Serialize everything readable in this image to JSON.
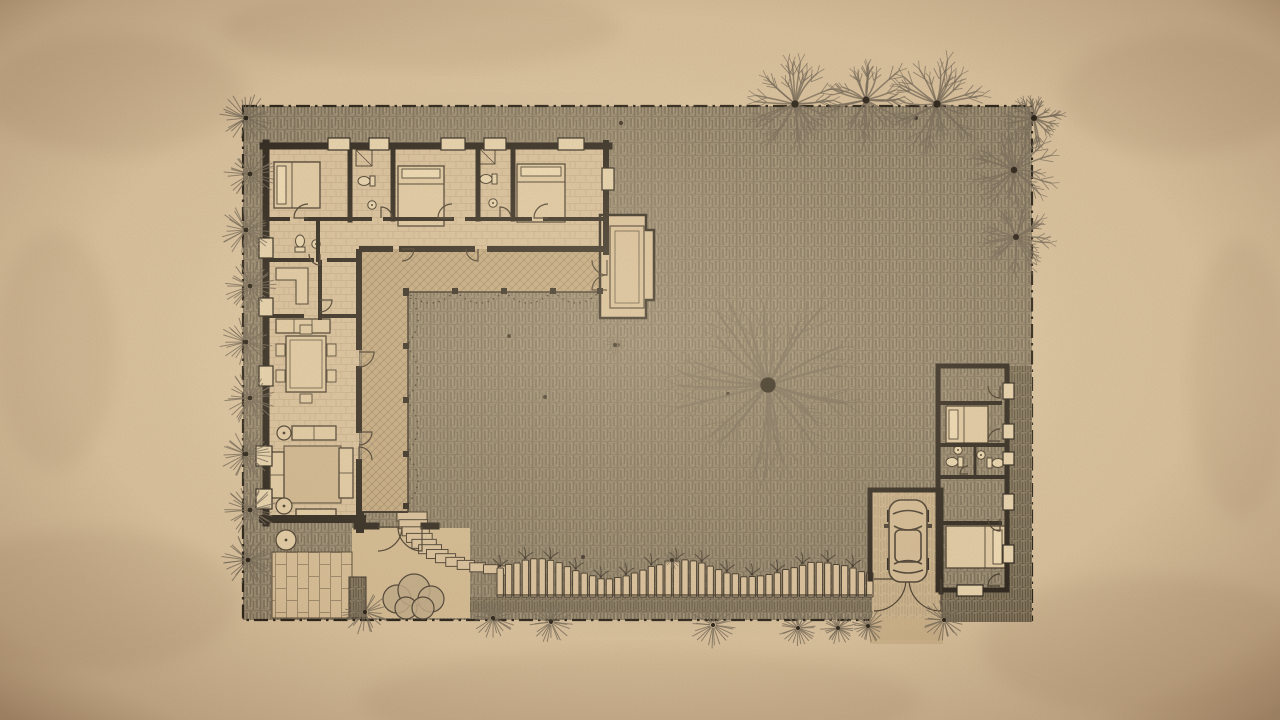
{
  "palette": {
    "paper": "#d8bf9b",
    "paper_light": "#ecd9b2",
    "paper_dark": "#7e5f42",
    "ground": "#8f8169",
    "ground_stroke": "#564b39",
    "ground_stroke_light": "#b6a587",
    "ground_row": "#453c2e",
    "wall": "#1c1610",
    "line": "#3a2f22",
    "window": "#e8d4ad",
    "floor": "#d9c09b",
    "floor_line": "#a58b68",
    "veranda": "#c4a87e",
    "veranda_line": "#7b684f",
    "patio": "#d5bb93",
    "patio_line": "#6d5b44",
    "deck": "#7f7259",
    "deck_line": "#463c2d",
    "drive": "#c9b089",
    "drive_line": "#8d775a",
    "terrace": "#d2b88f",
    "porch": "#dcc39c",
    "tree": "#6c6050",
    "trunk": "#171109",
    "shrub": "#bca684",
    "fence_slat": "#d9c09a",
    "fence_line": "#2e251b",
    "dot": "#2a211a"
  },
  "site": {
    "x": 243,
    "y": 106,
    "w": 789,
    "h": 514,
    "boundary_dash": "14 5 2.5 5"
  },
  "walls": [
    [
      263,
      146,
      609,
      146,
      7
    ],
    [
      266,
      143,
      266,
      523,
      7
    ],
    [
      606,
      143,
      606,
      252,
      6
    ],
    [
      263,
      519,
      362,
      519,
      8
    ],
    [
      360,
      516,
      360,
      529,
      8
    ],
    [
      357,
      526,
      376,
      526,
      7
    ],
    [
      424,
      526,
      436,
      526,
      7
    ],
    [
      359,
      252,
      359,
      347,
      6
    ],
    [
      359,
      369,
      359,
      430,
      6
    ],
    [
      359,
      462,
      359,
      514,
      6
    ],
    [
      362,
      249,
      390,
      249,
      6
    ],
    [
      402,
      249,
      472,
      249,
      6
    ],
    [
      490,
      249,
      604,
      249,
      6
    ],
    [
      350,
      146,
      350,
      220,
      5
    ],
    [
      393,
      146,
      393,
      219,
      5
    ],
    [
      478,
      146,
      478,
      219,
      5
    ],
    [
      513,
      146,
      513,
      219,
      5
    ],
    [
      266,
      219,
      288,
      219,
      4
    ],
    [
      306,
      219,
      370,
      219,
      4
    ],
    [
      385,
      219,
      452,
      219,
      4
    ],
    [
      467,
      219,
      530,
      219,
      4
    ],
    [
      545,
      219,
      604,
      219,
      4
    ],
    [
      318,
      222,
      318,
      260,
      4
    ],
    [
      266,
      260,
      312,
      260,
      4
    ],
    [
      329,
      260,
      359,
      260,
      4
    ],
    [
      320,
      262,
      320,
      318,
      4
    ],
    [
      266,
      316,
      302,
      316,
      4
    ],
    [
      320,
      316,
      359,
      316,
      4
    ],
    [
      938,
      366,
      1007,
      366,
      5
    ],
    [
      1007,
      366,
      1007,
      590,
      5
    ],
    [
      938,
      590,
      1007,
      590,
      5
    ],
    [
      938,
      366,
      938,
      590,
      5
    ],
    [
      940,
      403,
      1000,
      403,
      4
    ],
    [
      938,
      445,
      1007,
      445,
      4
    ],
    [
      938,
      477,
      1007,
      477,
      4
    ],
    [
      940,
      523,
      1000,
      523,
      4
    ],
    [
      975,
      445,
      975,
      477,
      3
    ],
    [
      870,
      490,
      941,
      490,
      5
    ],
    [
      870,
      490,
      870,
      579,
      5
    ],
    [
      941,
      490,
      941,
      592,
      5
    ]
  ],
  "windows": [
    [
      328,
      138,
      22,
      12
    ],
    [
      369,
      138,
      20,
      12
    ],
    [
      441,
      138,
      24,
      12
    ],
    [
      484,
      138,
      22,
      12
    ],
    [
      558,
      138,
      26,
      12
    ],
    [
      259,
      238,
      14,
      20
    ],
    [
      259,
      298,
      14,
      18
    ],
    [
      259,
      366,
      14,
      20
    ],
    [
      256,
      446,
      16,
      20
    ],
    [
      256,
      489,
      16,
      20
    ],
    [
      602,
      168,
      12,
      22
    ],
    [
      1003,
      383,
      11,
      16
    ],
    [
      1003,
      424,
      11,
      15
    ],
    [
      1003,
      452,
      11,
      13
    ],
    [
      1003,
      494,
      11,
      16
    ],
    [
      1003,
      545,
      11,
      18
    ],
    [
      957,
      585,
      26,
      11
    ]
  ],
  "doors": [
    [
      308,
      218,
      14,
      180,
      270
    ],
    [
      381,
      218,
      11,
      270,
      360
    ],
    [
      452,
      218,
      14,
      180,
      270
    ],
    [
      500,
      218,
      11,
      270,
      360
    ],
    [
      548,
      218,
      14,
      180,
      270
    ],
    [
      402,
      249,
      12,
      0,
      90
    ],
    [
      478,
      249,
      12,
      90,
      180
    ],
    [
      320,
      254,
      11,
      90,
      180
    ],
    [
      320,
      300,
      12,
      0,
      90
    ],
    [
      359,
      352,
      15,
      0,
      90
    ],
    [
      359,
      432,
      13,
      0,
      90
    ],
    [
      359,
      460,
      13,
      270,
      360
    ],
    [
      378,
      527,
      24,
      0,
      90
    ],
    [
      422,
      527,
      24,
      90,
      180
    ],
    [
      607,
      260,
      15,
      90,
      180
    ],
    [
      607,
      290,
      15,
      180,
      270
    ],
    [
      1000,
      386,
      12,
      90,
      180
    ],
    [
      1000,
      441,
      12,
      180,
      270
    ],
    [
      968,
      474,
      8,
      180,
      270
    ],
    [
      1000,
      519,
      12,
      90,
      180
    ],
    [
      1000,
      586,
      12,
      180,
      270
    ],
    [
      874,
      579,
      32,
      0,
      90
    ],
    [
      941,
      579,
      32,
      90,
      180
    ]
  ],
  "posts": [
    [
      406,
      291
    ],
    [
      406,
      293
    ],
    [
      406,
      346
    ],
    [
      406,
      400
    ],
    [
      406,
      454
    ],
    [
      406,
      506
    ],
    [
      455,
      291
    ],
    [
      504,
      291
    ],
    [
      553,
      291
    ],
    [
      600,
      291
    ]
  ],
  "swags": {
    "v": {
      "x": 406,
      "ys": [
        293,
        346,
        400,
        454,
        506
      ]
    },
    "h": {
      "y": 291,
      "xs": [
        406,
        455,
        504,
        553,
        600
      ]
    },
    "sag": 24
  },
  "dots": [
    [
      545,
      397
    ],
    [
      621,
      123
    ],
    [
      583,
      557
    ],
    [
      509,
      336
    ],
    [
      728,
      394
    ],
    [
      916,
      118
    ],
    [
      618,
      345
    ]
  ],
  "trees": {
    "big": [
      768,
      385,
      96
    ],
    "branchy": [
      [
        795,
        104,
        46
      ],
      [
        866,
        100,
        44
      ],
      [
        937,
        104,
        46
      ],
      [
        1014,
        170,
        40
      ],
      [
        1016,
        237,
        38
      ],
      [
        1034,
        118,
        28
      ]
    ],
    "left_col": {
      "x": [
        246,
        250,
        246,
        250,
        246,
        250,
        246,
        250,
        248
      ],
      "y": [
        118,
        174,
        230,
        286,
        342,
        398,
        454,
        510,
        560
      ],
      "r": 27
    },
    "bottom": [
      [
        365,
        612,
        24
      ],
      [
        493,
        618,
        22
      ],
      [
        551,
        622,
        22
      ],
      [
        713,
        625,
        24
      ],
      [
        798,
        628,
        20
      ],
      [
        838,
        628,
        18
      ],
      [
        868,
        626,
        18
      ],
      [
        944,
        620,
        22
      ]
    ],
    "plants": [
      [
        615,
        345,
        12
      ],
      [
        672,
        560,
        10
      ]
    ]
  },
  "fence": {
    "x0": 497,
    "x1": 872,
    "y_bottom": 597,
    "slat_w": 6.4,
    "pitch": 8.4,
    "amp": 8,
    "period": 140,
    "y_top": 569
  },
  "steps": {
    "p0": [
      412,
      512
    ],
    "p1": [
      416,
      560
    ],
    "p2": [
      505,
      566
    ],
    "n": 13,
    "w0": 30,
    "w1": 13,
    "h": 9
  },
  "furniture": [
    {
      "t": "bed",
      "x": 274,
      "y": 162,
      "w": 46,
      "h": 46,
      "head": "w"
    },
    {
      "t": "bed",
      "x": 398,
      "y": 166,
      "w": 46,
      "h": 60,
      "head": "n"
    },
    {
      "t": "bed",
      "x": 517,
      "y": 164,
      "w": 48,
      "h": 58,
      "head": "n"
    },
    {
      "t": "bed",
      "x": 946,
      "y": 406,
      "w": 42,
      "h": 37,
      "head": "w"
    },
    {
      "t": "bed",
      "x": 946,
      "y": 526,
      "w": 59,
      "h": 42,
      "head": "e"
    },
    {
      "t": "shower",
      "x": 356,
      "y": 150,
      "w": 16,
      "h": 16
    },
    {
      "t": "shower",
      "x": 480,
      "y": 149,
      "w": 15,
      "h": 15
    },
    {
      "t": "toilet",
      "x": 366,
      "y": 181,
      "rot": 90
    },
    {
      "t": "toilet",
      "x": 488,
      "y": 179,
      "rot": 90
    },
    {
      "t": "toilet",
      "x": 300,
      "y": 243,
      "rot": 180
    },
    {
      "t": "toilet",
      "x": 954,
      "y": 462,
      "rot": 90
    },
    {
      "t": "toilet",
      "x": 996,
      "y": 463,
      "rot": 270
    },
    {
      "t": "sink",
      "x": 372,
      "y": 205
    },
    {
      "t": "sink",
      "x": 493,
      "y": 203
    },
    {
      "t": "sink",
      "x": 316,
      "y": 244
    },
    {
      "t": "sink",
      "x": 958,
      "y": 450
    },
    {
      "t": "sink",
      "x": 981,
      "y": 455
    },
    {
      "t": "desk",
      "x": 276,
      "y": 268,
      "w": 32,
      "h": 36
    },
    {
      "t": "counter",
      "x": 276,
      "y": 319,
      "w": 54,
      "h": 14
    },
    {
      "t": "dining",
      "x": 286,
      "y": 336,
      "w": 40,
      "h": 56
    },
    {
      "t": "rug",
      "x": 284,
      "y": 446,
      "w": 57,
      "h": 57
    },
    {
      "t": "sofa",
      "x": 270,
      "y": 452,
      "w": 14,
      "h": 46
    },
    {
      "t": "sofa",
      "x": 339,
      "y": 448,
      "w": 14,
      "h": 50
    },
    {
      "t": "sofa",
      "x": 292,
      "y": 426,
      "w": 44,
      "h": 14
    },
    {
      "t": "ctable",
      "x": 284,
      "y": 433,
      "r": 7
    },
    {
      "t": "ctable",
      "x": 284,
      "y": 506,
      "r": 8
    },
    {
      "t": "console",
      "x": 296,
      "y": 509,
      "w": 40,
      "h": 7
    },
    {
      "t": "ctable",
      "x": 286,
      "y": 540,
      "r": 10
    }
  ],
  "stains": {
    "dark": [
      [
        1150,
        645,
        170,
        70
      ],
      [
        115,
        95,
        130,
        60
      ],
      [
        1180,
        95,
        120,
        60
      ],
      [
        90,
        600,
        150,
        70
      ],
      [
        640,
        700,
        280,
        50
      ],
      [
        420,
        28,
        200,
        40
      ],
      [
        55,
        350,
        60,
        120
      ],
      [
        1240,
        380,
        50,
        140
      ]
    ],
    "light": [
      [
        620,
        350,
        430,
        260
      ]
    ]
  }
}
